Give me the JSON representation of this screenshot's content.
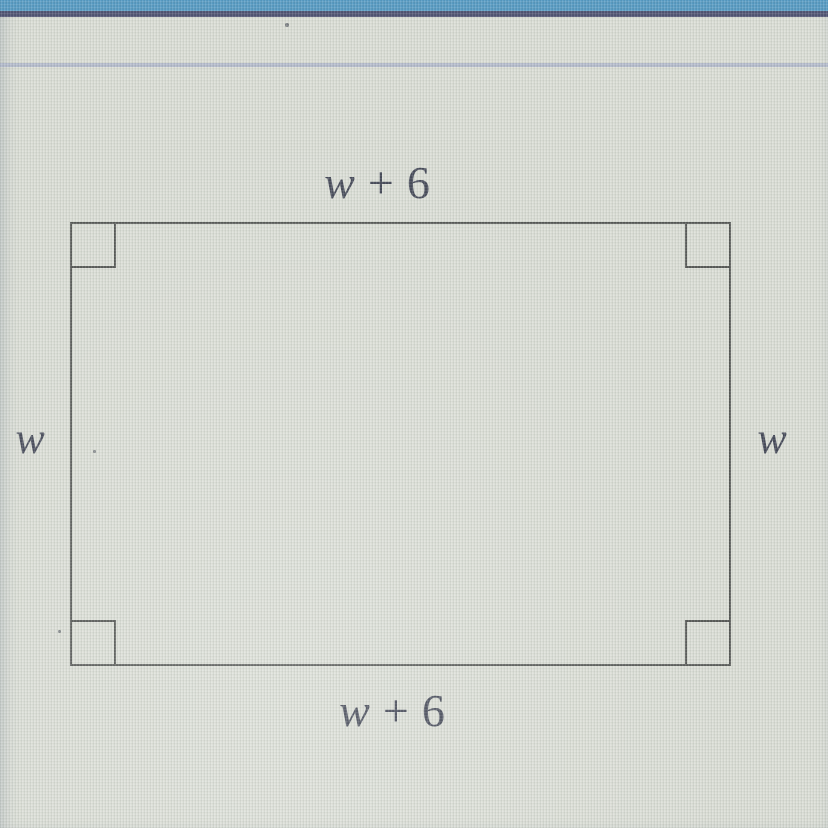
{
  "window": {
    "top_bar_color": "#4e95c0",
    "top_bar_edge_color": "#474a6c",
    "background_color": "#d9dcd4",
    "rule_color": "#a9b2c8"
  },
  "diagram": {
    "shape": "rectangle",
    "stroke_color": "#4e504e",
    "label_color": "#3c4050",
    "right_angle_markers": [
      "top-left",
      "top-right",
      "bottom-left",
      "bottom-right"
    ],
    "labels": {
      "top": {
        "var": "w",
        "op": "+",
        "num": "6"
      },
      "bottom": {
        "var": "w",
        "op": "+",
        "num": "6"
      },
      "left": {
        "var": "w"
      },
      "right": {
        "var": "w"
      }
    }
  }
}
